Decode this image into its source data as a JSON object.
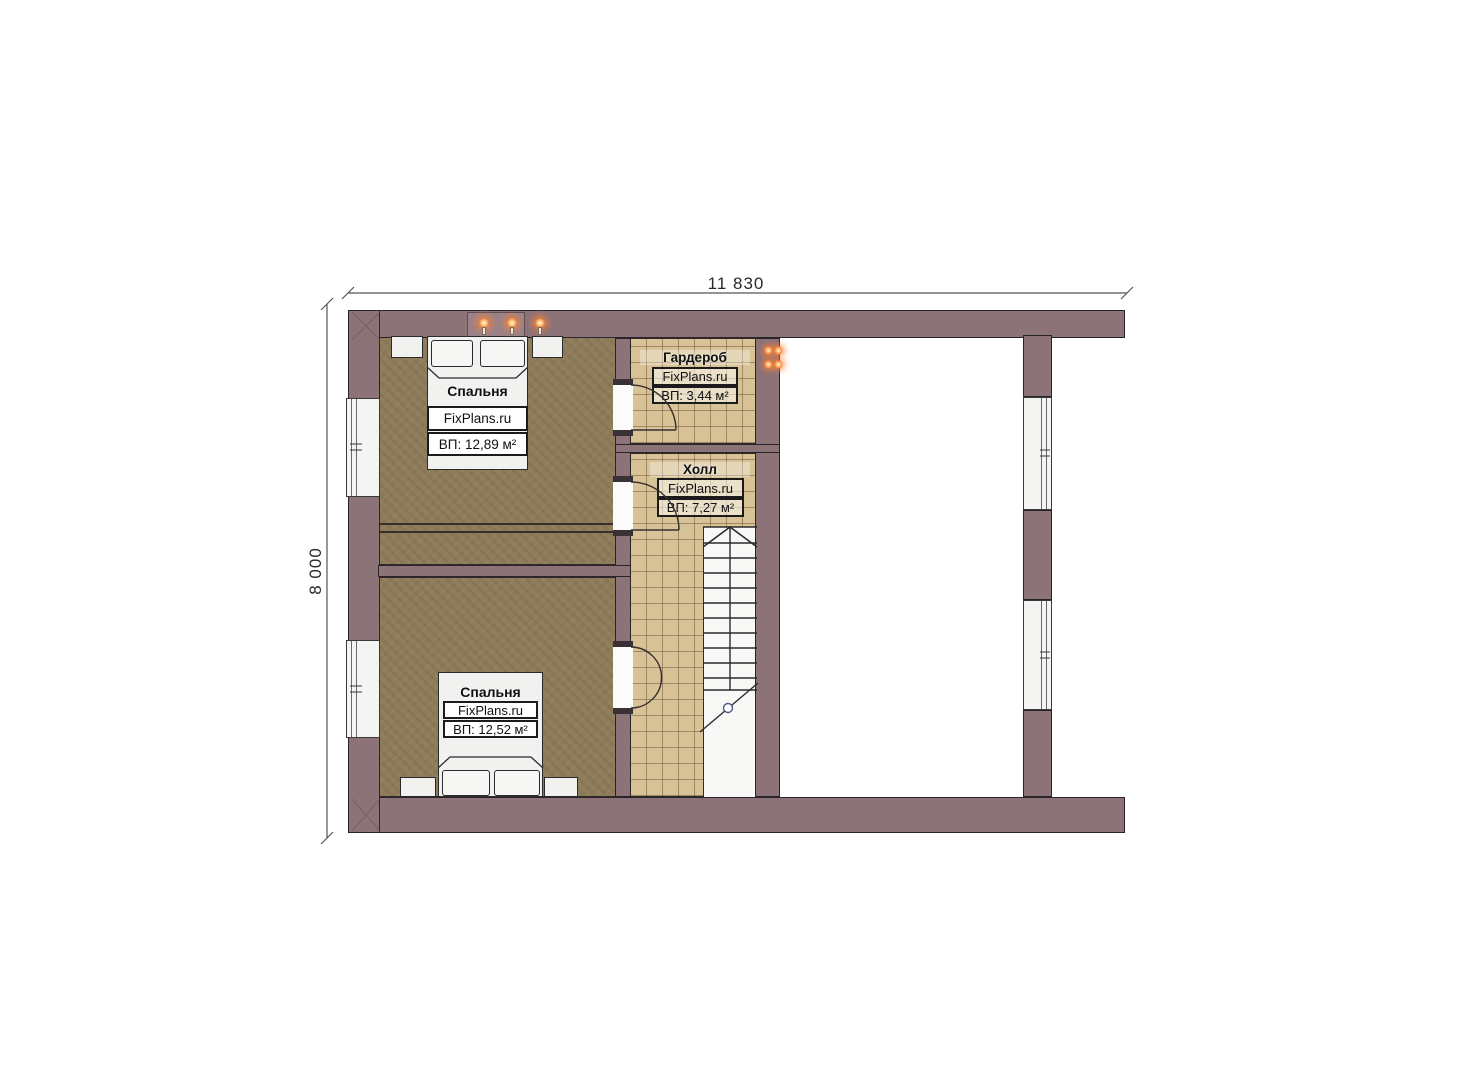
{
  "plan": {
    "type": "floor-plan",
    "dimensions": {
      "top": "11 830",
      "left": "8 000"
    },
    "rooms": [
      {
        "name": "Спальня",
        "brand": "FixPlans.ru",
        "area": "ВП: 12,89 м²"
      },
      {
        "name": "Гардероб",
        "brand": "FixPlans.ru",
        "area": "ВП: 3,44 м²"
      },
      {
        "name": "Холл",
        "brand": "FixPlans.ru",
        "area": "ВП: 7,27 м²"
      },
      {
        "name": "Спальня",
        "brand": "FixPlans.ru",
        "area": "ВП: 12,52 м²"
      }
    ],
    "colors": {
      "wall": "#8b7378",
      "wood_floor": "#8e7c5a",
      "tile_floor": "#d8c396",
      "light_glow": "#ff8a3c",
      "outline": "#2b2b2b"
    }
  }
}
